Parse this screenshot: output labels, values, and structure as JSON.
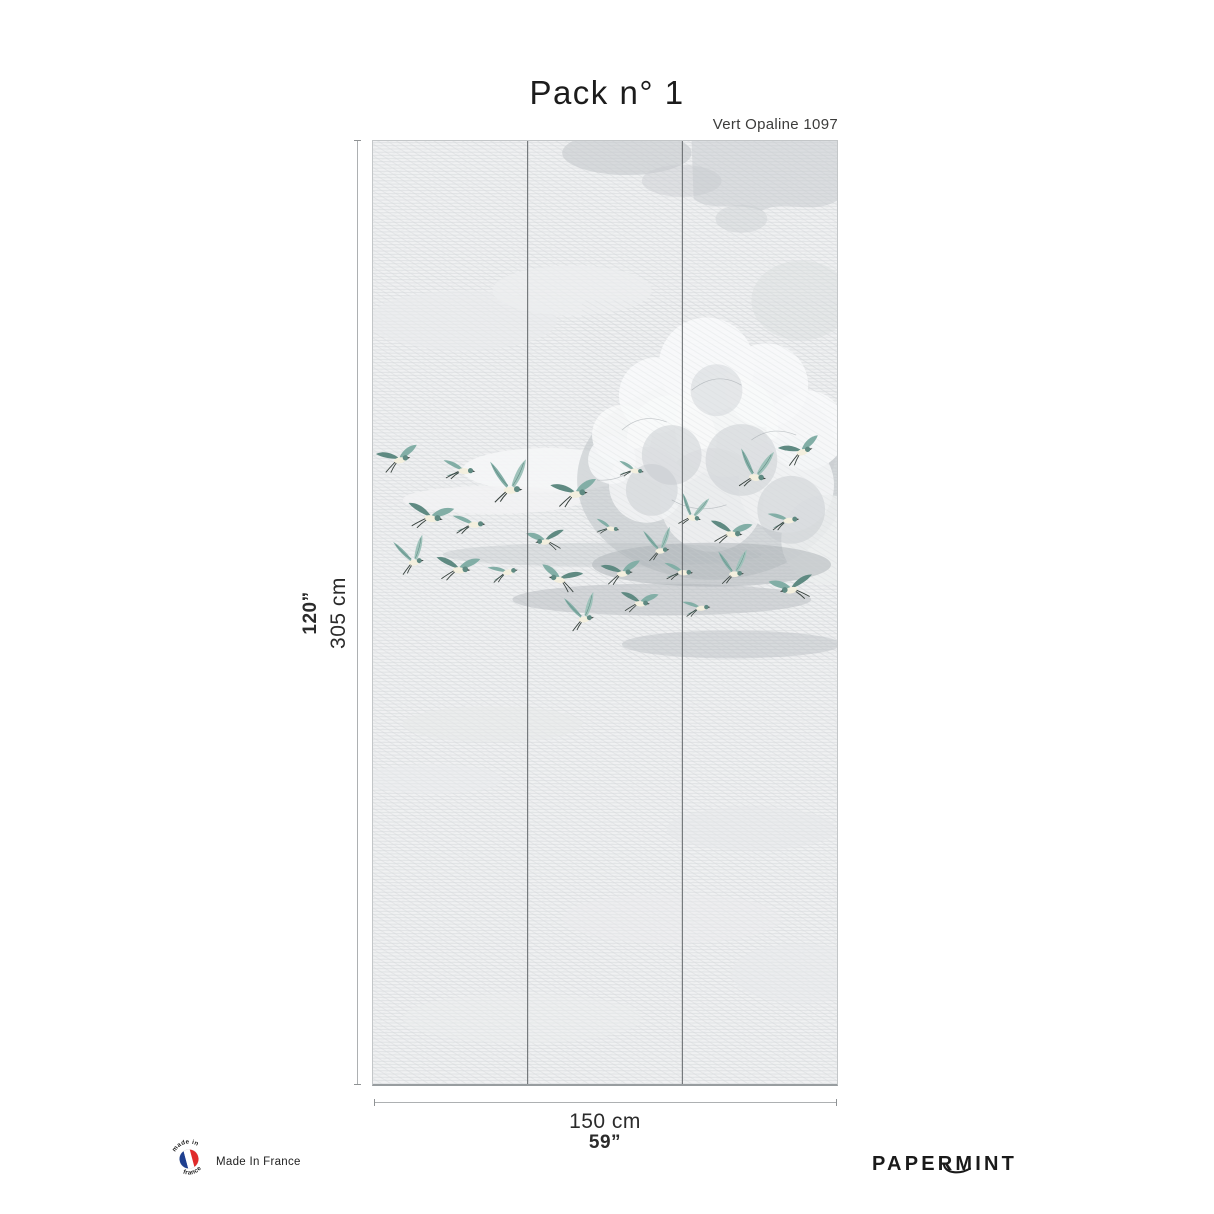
{
  "page": {
    "title": "Pack n° 1",
    "subtitle": "Vert Opaline 1097"
  },
  "dimensions": {
    "height_in": "120”",
    "height_cm": "305 cm",
    "width_cm": "150 cm",
    "width_in": "59”"
  },
  "footer": {
    "badge_text_top": "made in",
    "badge_text_bottom": "france",
    "made_in_france_label": "Made In France",
    "brand": "PAPERMINT"
  },
  "panel": {
    "drops": 3,
    "colors": {
      "bird_teal": "#82aea6",
      "bird_teal_light": "#9ec2ba",
      "bird_teal_dark": "#5f8a82",
      "bird_body": "#f3efde",
      "bird_dark": "#39433f",
      "divider": "#5f6366",
      "sky_base": "#f0f1f2",
      "hatch_line": "#d3d6d9",
      "cloud_shadow": "#bec3c7",
      "flag_blue": "#1e3f8f",
      "flag_red": "#e02a2a"
    },
    "birds": [
      {
        "x": 26,
        "y": 318,
        "v": "glide",
        "s": 1.0,
        "r": -10,
        "f": 1
      },
      {
        "x": 90,
        "y": 330,
        "v": "sweep",
        "s": 1.0,
        "r": 5,
        "f": 1
      },
      {
        "x": 138,
        "y": 342,
        "v": "soar",
        "s": 1.2,
        "r": 0,
        "f": 1
      },
      {
        "x": 203,
        "y": 352,
        "v": "glide",
        "s": 1.1,
        "r": -5,
        "f": 1
      },
      {
        "x": 262,
        "y": 330,
        "v": "sweep",
        "s": 0.8,
        "r": 10,
        "f": 1
      },
      {
        "x": 322,
        "y": 372,
        "v": "soar",
        "s": 0.9,
        "r": 15,
        "f": 1
      },
      {
        "x": 385,
        "y": 330,
        "v": "soar",
        "s": 1.1,
        "r": 10,
        "f": 1
      },
      {
        "x": 430,
        "y": 310,
        "v": "glide",
        "s": 1.0,
        "r": -15,
        "f": 1
      },
      {
        "x": 58,
        "y": 376,
        "v": "glide",
        "s": 1.1,
        "r": 10,
        "f": 1
      },
      {
        "x": 100,
        "y": 384,
        "v": "sweep",
        "s": 1.0,
        "r": 0,
        "f": 1
      },
      {
        "x": 173,
        "y": 400,
        "v": "glide",
        "s": 0.9,
        "r": -8,
        "f": -1
      },
      {
        "x": 238,
        "y": 388,
        "v": "sweep",
        "s": 0.75,
        "r": 12,
        "f": 1
      },
      {
        "x": 288,
        "y": 405,
        "v": "soar",
        "s": 0.9,
        "r": -5,
        "f": 1
      },
      {
        "x": 360,
        "y": 392,
        "v": "glide",
        "s": 1.0,
        "r": 8,
        "f": 1
      },
      {
        "x": 416,
        "y": 380,
        "v": "sweep",
        "s": 0.95,
        "r": -5,
        "f": 1
      },
      {
        "x": 40,
        "y": 416,
        "v": "soar",
        "s": 1.0,
        "r": -10,
        "f": 1
      },
      {
        "x": 86,
        "y": 428,
        "v": "glide",
        "s": 1.05,
        "r": 5,
        "f": 1
      },
      {
        "x": 134,
        "y": 432,
        "v": "sweep",
        "s": 0.9,
        "r": -10,
        "f": 1
      },
      {
        "x": 188,
        "y": 438,
        "v": "glide",
        "s": 1.0,
        "r": 10,
        "f": -1
      },
      {
        "x": 250,
        "y": 432,
        "v": "glide",
        "s": 0.95,
        "r": -5,
        "f": 1
      },
      {
        "x": 310,
        "y": 432,
        "v": "sweep",
        "s": 0.9,
        "r": 5,
        "f": 1
      },
      {
        "x": 363,
        "y": 428,
        "v": "soar",
        "s": 0.95,
        "r": 0,
        "f": 1
      },
      {
        "x": 420,
        "y": 448,
        "v": "glide",
        "s": 1.05,
        "r": -12,
        "f": -1
      },
      {
        "x": 211,
        "y": 473,
        "v": "soar",
        "s": 1.0,
        "r": -8,
        "f": 1
      },
      {
        "x": 268,
        "y": 462,
        "v": "glide",
        "s": 0.9,
        "r": 6,
        "f": 1
      },
      {
        "x": 328,
        "y": 468,
        "v": "sweep",
        "s": 0.85,
        "r": -4,
        "f": 1
      }
    ]
  }
}
